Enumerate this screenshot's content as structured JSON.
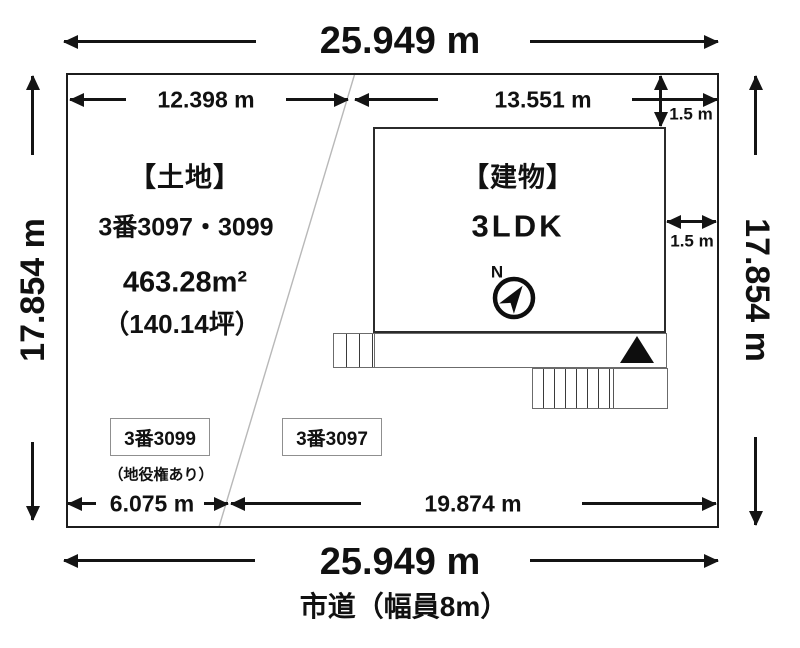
{
  "diagram": {
    "outer": {
      "top_width": "25.949 m",
      "bottom_width": "25.949 m",
      "left_depth": "17.854 m",
      "right_depth": "17.854 m",
      "road_label": "市道（幅員8m）"
    },
    "segments": {
      "top_left": "12.398 m",
      "top_right": "13.551 m",
      "setback_top": "1.5 m",
      "setback_right": "1.5 m",
      "bottom_left": "6.075 m",
      "bottom_right": "19.874 m"
    },
    "land": {
      "heading": "【土地】",
      "lot_numbers": "3番3097・3099",
      "area_sqm": "463.28m²",
      "area_tsubo": "（140.14坪）"
    },
    "parcels": {
      "left_label": "3番3099",
      "left_note": "（地役権あり）",
      "right_label": "3番3097"
    },
    "building": {
      "heading": "【建物】",
      "layout": "3LDK",
      "compass_label": "N"
    },
    "colors": {
      "line": "#141414",
      "structure_line": "#6b6b6b",
      "diagonal_line": "#b8b8b8",
      "parcel_box_border": "#8f8f8f"
    }
  }
}
